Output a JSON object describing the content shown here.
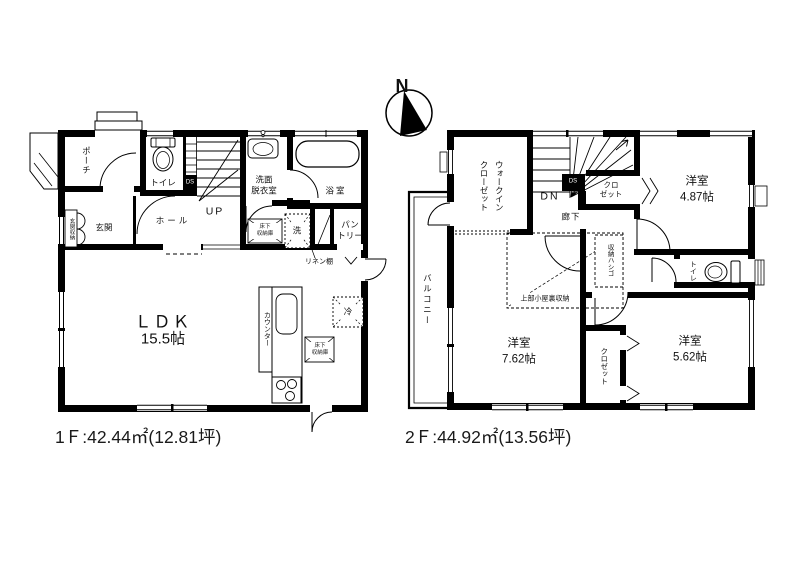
{
  "compass": {
    "north_label": "N"
  },
  "floor1": {
    "area_label": "1Ｆ:42.44㎡(12.81坪)",
    "rooms": {
      "porch": "ポーチ",
      "toilet": "トイレ",
      "duct": "DS",
      "washroom": "洗面\n脱衣室",
      "bath": "浴室",
      "entrance_storage": "玄関収納",
      "entrance": "玄関",
      "hall": "ホール",
      "stairs_up": "UP",
      "underfloor_storage": "床下\n収納庫",
      "washer": "洗",
      "pantry": "パン\nトリー",
      "linen_shelf": "リネン棚",
      "ldk": "ＬＤＫ",
      "ldk_size": "15.5帖",
      "counter": "カウンター",
      "fridge": "冷",
      "kitchen_underfloor_storage": "床下\n収納庫"
    }
  },
  "floor2": {
    "area_label": "2Ｆ:44.92㎡(13.56坪)",
    "rooms": {
      "walk_in_closet": "ウォークイン\nクローゼット",
      "stairs_down": "DN",
      "duct": "DS",
      "closet_top": "クロ\nゼット",
      "bedroom1": "洋室\n4.87帖",
      "hallway": "廊下",
      "storage_ladder": "収納ハシゴ",
      "attic_storage": "上部小屋裏収納",
      "toilet": "トイレ",
      "balcony": "バルコニー",
      "bedroom2": "洋室\n7.62帖",
      "closet_mid": "クロゼット",
      "bedroom3": "洋室\n5.62帖"
    }
  },
  "colors": {
    "wall": "#000000",
    "background": "#ffffff"
  }
}
